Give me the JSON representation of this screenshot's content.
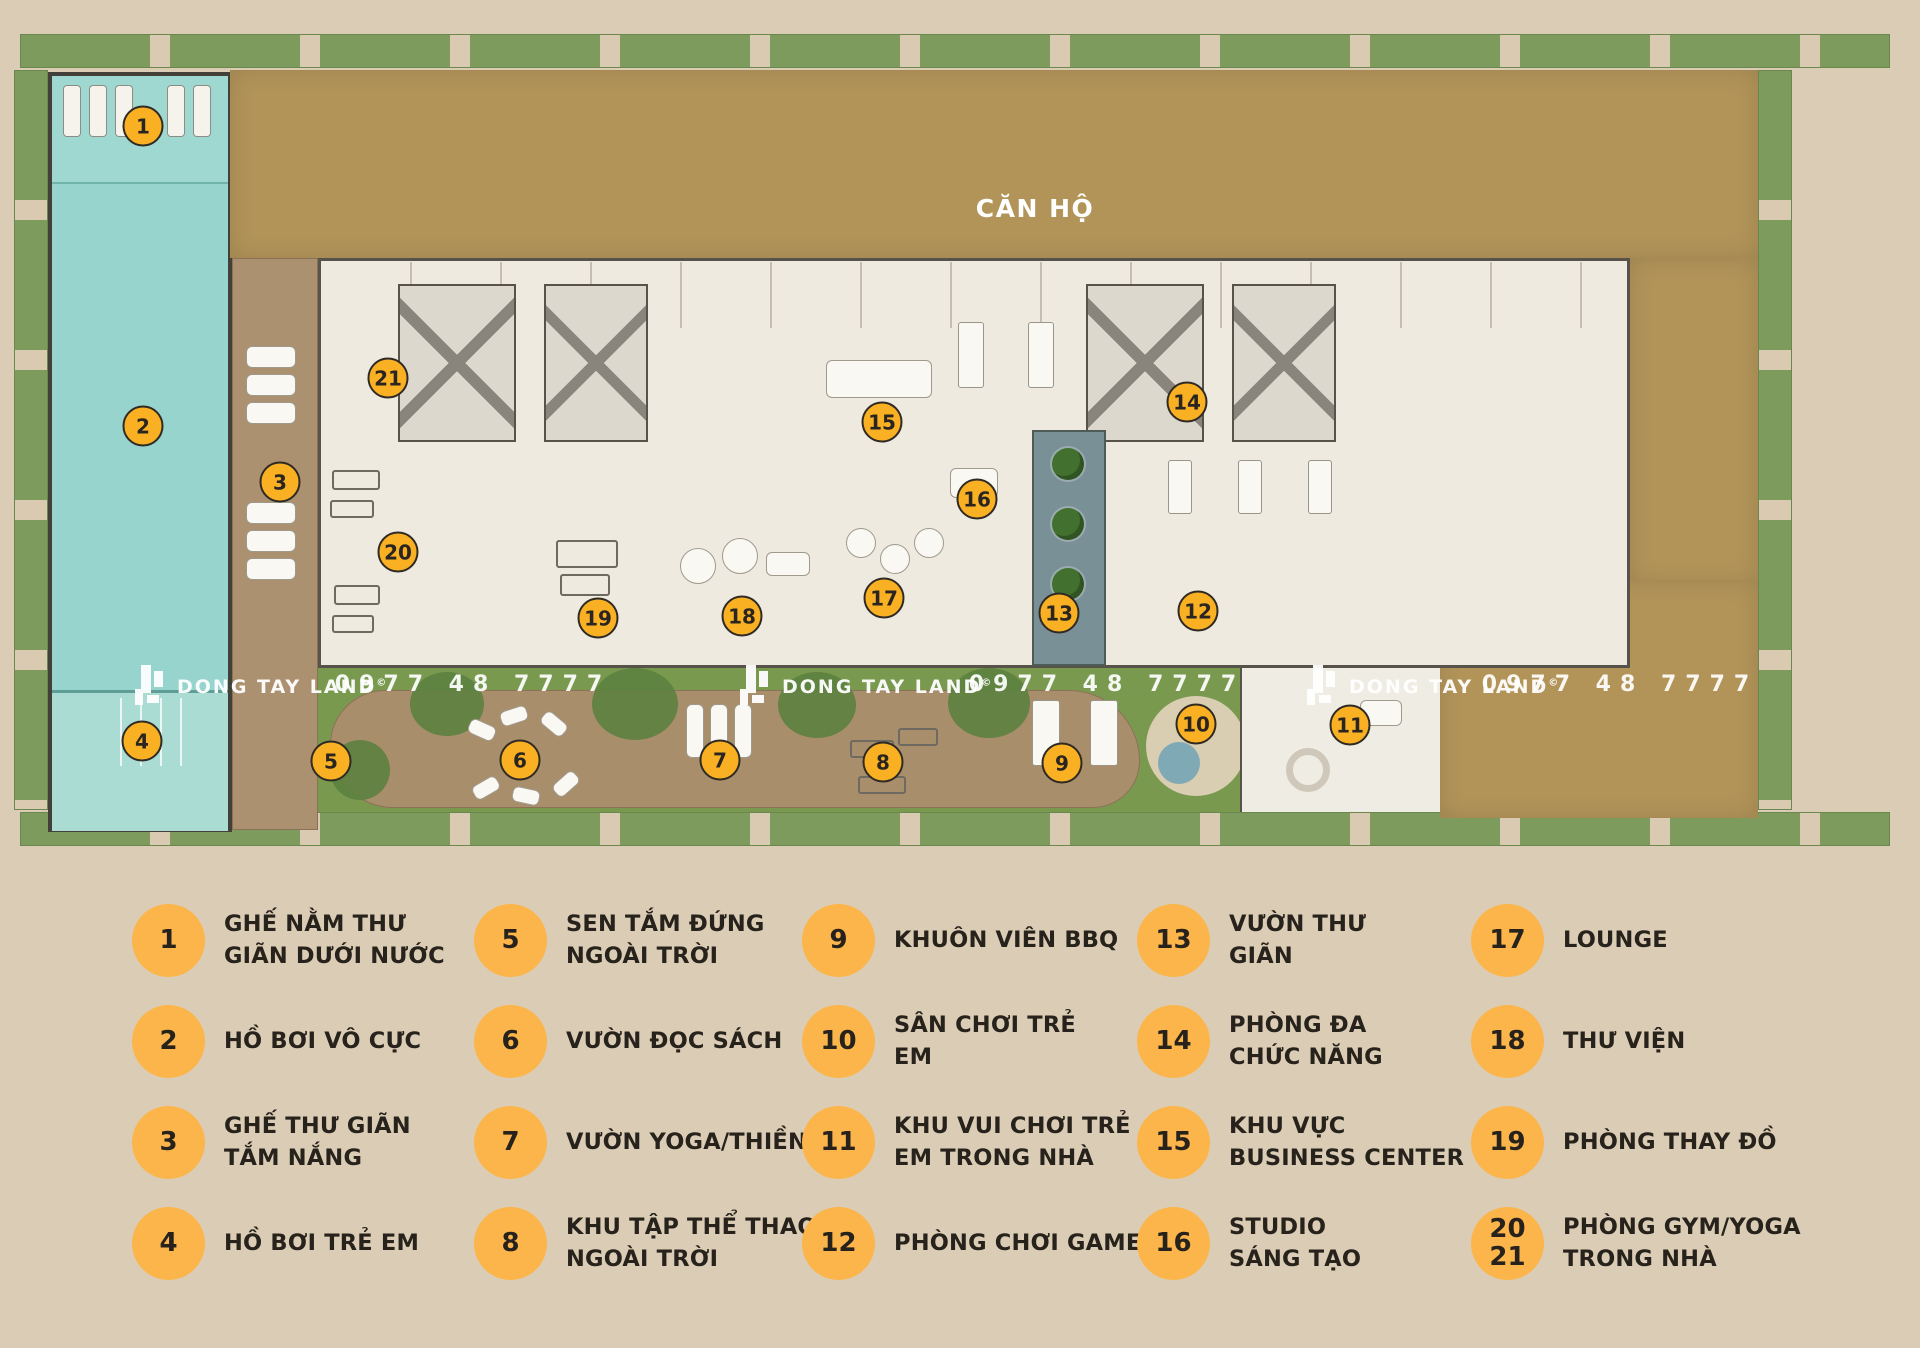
{
  "plan": {
    "building_label": "CĂN HỘ",
    "watermark": {
      "brand": "DONG TAY LAND",
      "registered": "©",
      "phone": "0977 48 7777",
      "instances": [
        {
          "logo_x": 133,
          "phone_x": 473
        },
        {
          "logo_x": 738,
          "phone_x": 1107
        },
        {
          "logo_x": 1305,
          "phone_x": 1620
        }
      ],
      "y": 687
    },
    "markers": [
      {
        "n": "1",
        "x": 143,
        "y": 126
      },
      {
        "n": "2",
        "x": 143,
        "y": 426
      },
      {
        "n": "3",
        "x": 280,
        "y": 482
      },
      {
        "n": "4",
        "x": 142,
        "y": 741
      },
      {
        "n": "5",
        "x": 331,
        "y": 761
      },
      {
        "n": "6",
        "x": 520,
        "y": 760
      },
      {
        "n": "7",
        "x": 720,
        "y": 760
      },
      {
        "n": "8",
        "x": 883,
        "y": 762
      },
      {
        "n": "9",
        "x": 1062,
        "y": 763
      },
      {
        "n": "10",
        "x": 1196,
        "y": 724
      },
      {
        "n": "11",
        "x": 1350,
        "y": 725
      },
      {
        "n": "12",
        "x": 1198,
        "y": 611
      },
      {
        "n": "13",
        "x": 1059,
        "y": 613
      },
      {
        "n": "14",
        "x": 1187,
        "y": 402
      },
      {
        "n": "15",
        "x": 882,
        "y": 422
      },
      {
        "n": "16",
        "x": 977,
        "y": 499
      },
      {
        "n": "17",
        "x": 884,
        "y": 598
      },
      {
        "n": "18",
        "x": 742,
        "y": 616
      },
      {
        "n": "19",
        "x": 598,
        "y": 618
      },
      {
        "n": "20",
        "x": 398,
        "y": 552
      },
      {
        "n": "21",
        "x": 388,
        "y": 378
      }
    ]
  },
  "legend": {
    "columns": [
      {
        "items": [
          {
            "num": "1",
            "label": "GHẾ NẰM THƯ\nGIÃN DƯỚI NƯỚC"
          },
          {
            "num": "2",
            "label": "HỒ BƠI VÔ CỰC"
          },
          {
            "num": "3",
            "label": "GHẾ THƯ GIÃN\nTẮM NẮNG"
          },
          {
            "num": "4",
            "label": "HỒ BƠI TRẺ EM"
          }
        ]
      },
      {
        "items": [
          {
            "num": "5",
            "label": "SEN TẮM ĐỨNG\nNGOÀI TRỜI"
          },
          {
            "num": "6",
            "label": "VƯỜN ĐỌC SÁCH"
          },
          {
            "num": "7",
            "label": "VƯỜN YOGA/THIỀN"
          },
          {
            "num": "8",
            "label": "KHU TẬP THỂ THAO\nNGOÀI TRỜI"
          }
        ]
      },
      {
        "items": [
          {
            "num": "9",
            "label": "KHUÔN VIÊN BBQ"
          },
          {
            "num": "10",
            "label": "SÂN CHƠI TRẺ\nEM"
          },
          {
            "num": "11",
            "label": "KHU VUI CHƠI TRẺ\nEM TRONG NHÀ"
          },
          {
            "num": "12",
            "label": "PHÒNG CHƠI GAME"
          }
        ]
      },
      {
        "items": [
          {
            "num": "13",
            "label": "VƯỜN THƯ\nGIÃN"
          },
          {
            "num": "14",
            "label": "PHÒNG ĐA\nCHỨC NĂNG"
          },
          {
            "num": "15",
            "label": "KHU VỰC\nBUSINESS CENTER"
          },
          {
            "num": "16",
            "label": "STUDIO\nSÁNG TẠO"
          }
        ]
      },
      {
        "items": [
          {
            "num": "17",
            "label": "LOUNGE"
          },
          {
            "num": "18",
            "label": "THƯ VIỆN"
          },
          {
            "num": "19",
            "label": "PHÒNG THAY ĐỒ"
          },
          {
            "num": "20\n21",
            "label": "PHÒNG GYM/YOGA\nTRONG NHÀ"
          }
        ]
      }
    ]
  },
  "colors": {
    "page_background": "#dbcdb5",
    "legend_circle": "#fbb54b",
    "plan_marker": "#f9b123",
    "text": "#27221b",
    "building_brown": "#b29459",
    "pool_teal": "#97d4cd",
    "grass_green": "#7d9b5c",
    "deck_wood": "#ab9170",
    "floor_cream": "#eeeae0",
    "watermark_white": "#ffffff"
  }
}
